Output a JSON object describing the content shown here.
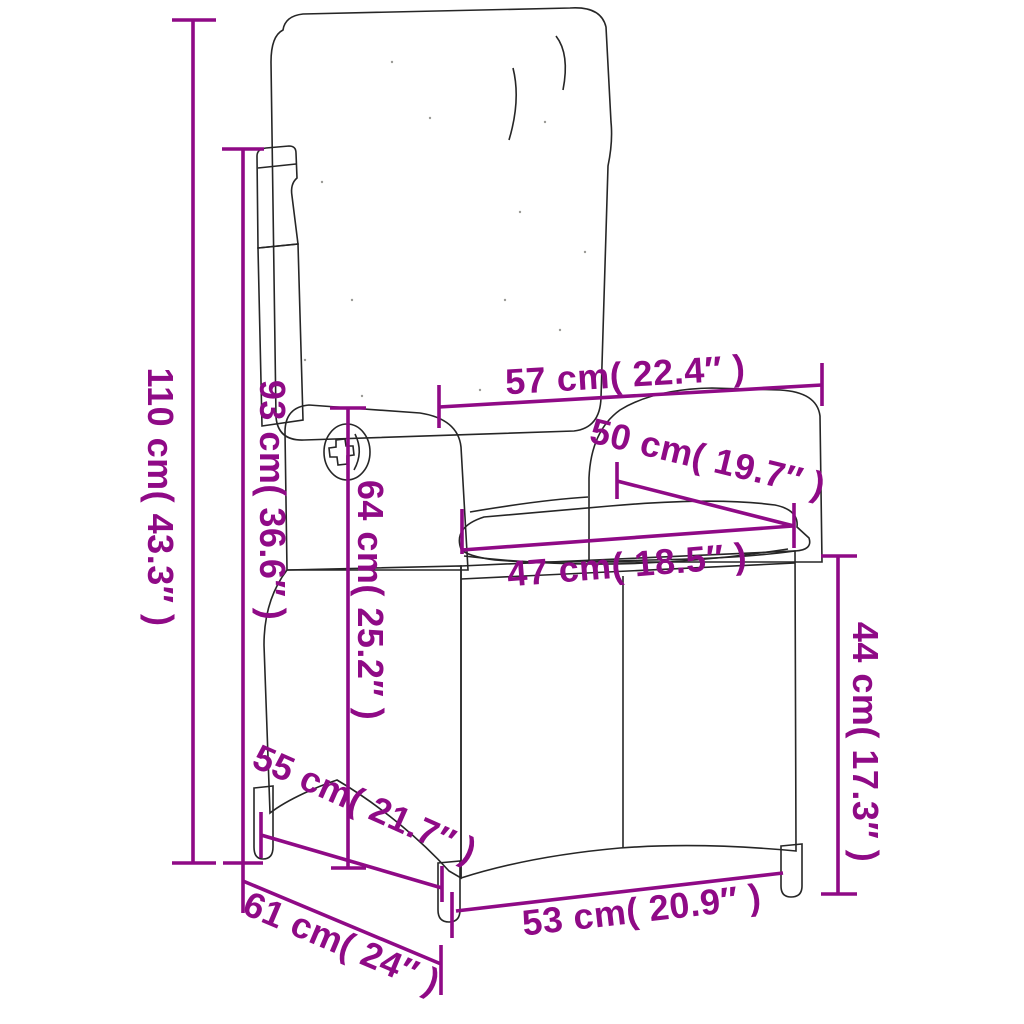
{
  "figure": {
    "subject": "reclining rattan garden chair with cushions, dimension diagram",
    "background": "#ffffff"
  },
  "colors": {
    "dimension": "#8F0A86",
    "outline": "#262626",
    "cushion_fill": "#fdfdfb"
  },
  "dimensions": [
    {
      "id": "total-height",
      "value_cm": 110,
      "value_in": "43.3",
      "label": "110 cm( 43.3″ )",
      "line": [
        193,
        20,
        193,
        863
      ],
      "ticks": [
        [
          172,
          20,
          216,
          20
        ],
        [
          172,
          863,
          216,
          863
        ]
      ],
      "text": {
        "x": 148,
        "y": 497,
        "rotate": 90
      }
    },
    {
      "id": "backrest-height",
      "value_cm": 93,
      "value_in": "36.6",
      "label": "93 cm( 36.6″ )",
      "line": [
        243,
        149,
        243,
        863
      ],
      "ticks": [
        [
          222,
          149,
          264,
          149
        ],
        [
          223,
          863,
          263,
          863
        ]
      ],
      "text": {
        "x": 260,
        "y": 500,
        "rotate": 90
      }
    },
    {
      "id": "top-width",
      "value_cm": 57,
      "value_in": "22.4",
      "label": "57 cm( 22.4″ )",
      "line": [
        439,
        407,
        822,
        385
      ],
      "ticks": [
        [
          439,
          385,
          439,
          428
        ],
        [
          822,
          363,
          822,
          406
        ]
      ],
      "text": {
        "x": 626,
        "y": 387,
        "rotate": -3.5
      }
    },
    {
      "id": "backrest-width",
      "value_cm": 50,
      "value_in": "19.7",
      "label": "50 cm( 19.7″ )",
      "line": [
        617,
        481,
        794,
        526
      ],
      "ticks": [
        [
          617,
          462,
          617,
          499
        ],
        [
          794,
          503,
          794,
          548
        ]
      ],
      "text": {
        "x": 705,
        "y": 470,
        "rotate": 13.5
      }
    },
    {
      "id": "seat-width",
      "value_cm": 47,
      "value_in": "18.5",
      "label": "47 cm( 18.5″ )",
      "line": [
        462,
        550,
        793,
        526
      ],
      "ticks": [
        [
          462,
          509,
          462,
          554
        ]
      ],
      "text": {
        "x": 628,
        "y": 577,
        "rotate": -4.5
      }
    },
    {
      "id": "armrest-height",
      "value_cm": 64,
      "value_in": "25.2",
      "label": "64 cm( 25.2″ )",
      "line": [
        348,
        408,
        348,
        868
      ],
      "ticks": [
        [
          330,
          408,
          366,
          408
        ],
        [
          331,
          868,
          366,
          868
        ]
      ],
      "text": {
        "x": 358,
        "y": 600,
        "rotate": 90
      }
    },
    {
      "id": "seat-depth",
      "value_cm": 55,
      "value_in": "21.7",
      "label": "55 cm( 21.7″ )",
      "line": [
        261,
        835,
        442,
        888
      ],
      "ticks": [
        [
          261,
          812,
          261,
          858
        ],
        [
          442,
          866,
          442,
          902
        ]
      ],
      "text": {
        "x": 360,
        "y": 815,
        "rotate": 24
      }
    },
    {
      "id": "base-depth",
      "value_cm": 61,
      "value_in": "24",
      "label": "61 cm( 24″ )",
      "line": [
        243,
        881,
        441,
        964
      ],
      "ticks": [
        [
          243,
          863,
          243,
          913
        ],
        [
          441,
          945,
          441,
          995
        ]
      ],
      "text": {
        "x": 337,
        "y": 954,
        "rotate": 23
      }
    },
    {
      "id": "base-height",
      "value_cm": 44,
      "value_in": "17.3",
      "label": "44 cm( 17.3″ )",
      "line": [
        838,
        556,
        838,
        894
      ],
      "ticks": [
        [
          821,
          556,
          857,
          556
        ],
        [
          821,
          894,
          857,
          894
        ]
      ],
      "text": {
        "x": 853,
        "y": 742,
        "rotate": 90
      }
    },
    {
      "id": "base-width",
      "value_cm": 53,
      "value_in": "20.9",
      "label": "53 cm( 20.9″ )",
      "line": [
        456,
        911,
        783,
        873
      ],
      "ticks": [
        [
          452,
          892,
          452,
          938
        ]
      ],
      "text": {
        "x": 643,
        "y": 922,
        "rotate": -6.5
      }
    }
  ],
  "style": {
    "dim_stroke_width": 3.6,
    "dim_font_size": 36
  }
}
